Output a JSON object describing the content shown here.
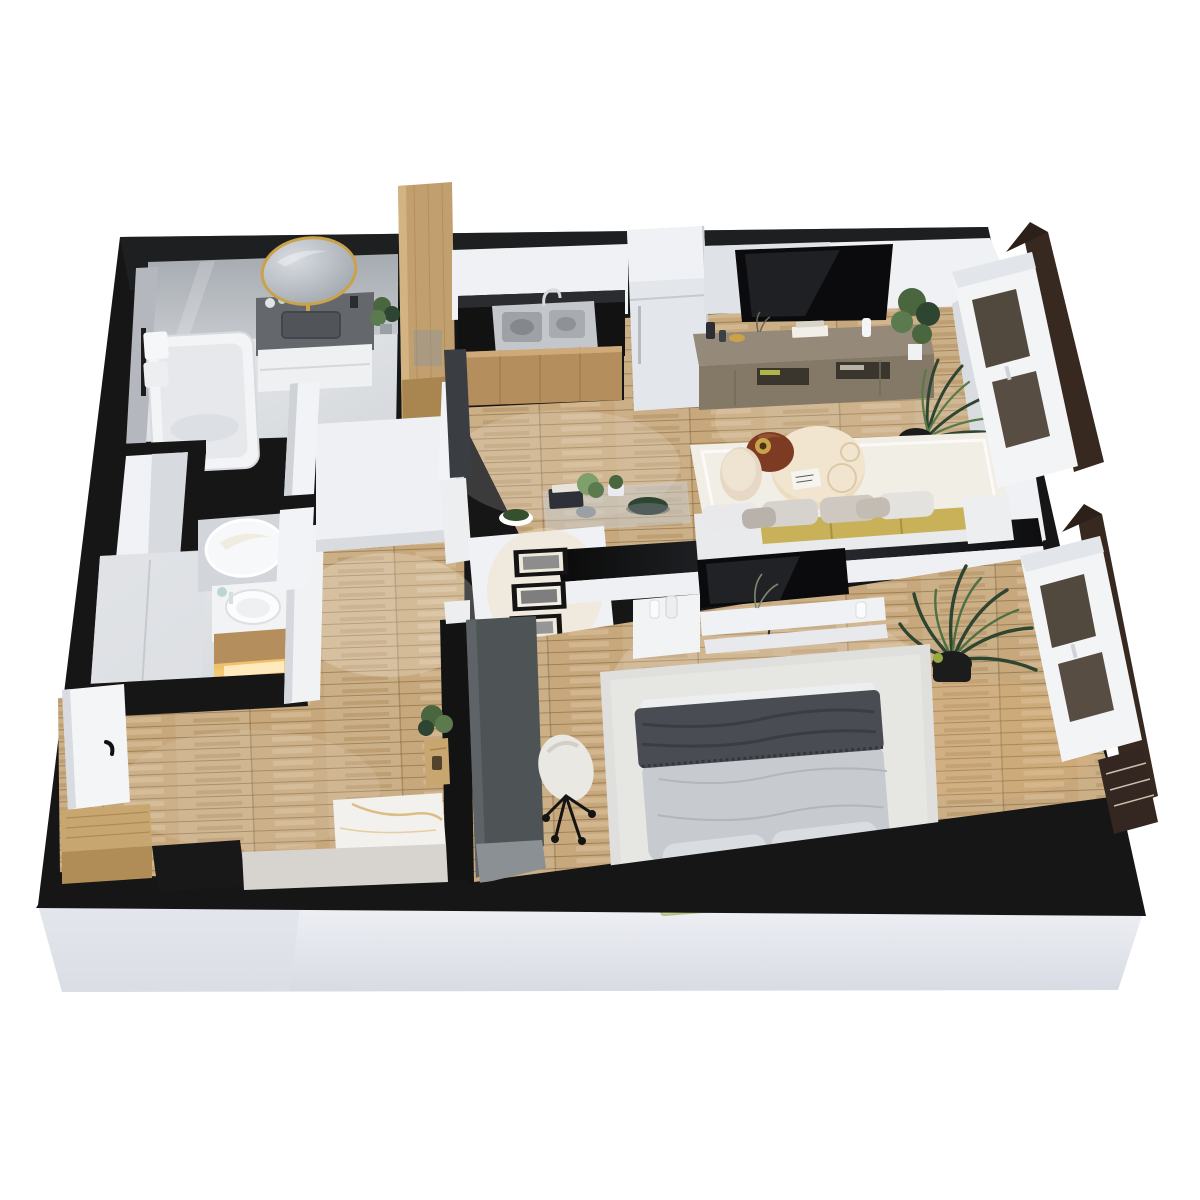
{
  "image": {
    "kind": "3d-floor-plan-render",
    "view": "isometric top-down",
    "apartment_type": "one-bedroom apartment",
    "visible_text": "none"
  },
  "palette": {
    "pageBg": "#ffffff",
    "wallBlack": "#161616",
    "wallBlackSheen": "#26282b",
    "fasciaLight": "#eef0f5",
    "fasciaDark": "#d8dbe3",
    "wallFaceWhite": "#eff1f4",
    "wallFaceGray": "#d9dbdf",
    "marbleLight": "#e9ebed",
    "marbleMid": "#d5d8db",
    "marbleDark": "#a6abb1",
    "wood": "#c7a87c",
    "woodDark": "#a9854f",
    "woodCabinet": "#b48e5c",
    "counterBlack": "#121212",
    "steel": "#c3c7cc",
    "fridge": "#e3e6ea",
    "tvBlack": "#0b0b0d",
    "consoleTaupe": "#95897a",
    "consoleTaupeDark": "#847866",
    "sofaWhite": "#e9eaec",
    "sofaGray": "#cdc6be",
    "seatMustard": "#c8b158",
    "tableCream": "#ecdcc2",
    "tableBrown": "#7e3b24",
    "rugLiving": "#f1eee6",
    "rugBedroom": "#dfdfdd",
    "bedDuvet": "#c7cacf",
    "bedThrow": "#494c53",
    "bedPillow": "#d9dce1",
    "headboardGreen": "#cdd5a0",
    "nightstandBrown": "#53351f",
    "deskGray": "#4e5456",
    "chairBoucle": "#eae8e2",
    "plantGreen": "#49663f",
    "plantDark": "#2e4531",
    "potBlack": "#1c1c1c",
    "windowBrown": "#372820",
    "gold": "#c9a24a",
    "glowWarm": "#f6c76d"
  },
  "scene": {
    "rooms": [
      {
        "id": "bathroom-main",
        "label": "bathroom",
        "contents": [
          "bathtub",
          "towel-rack with white towels",
          "gray vanity with sink and gold faucet",
          "round gold-framed mirror",
          "green plant",
          "gray marble walls"
        ]
      },
      {
        "id": "closet-niche",
        "label": "closet niche",
        "contents": [
          "open built-in niche"
        ]
      },
      {
        "id": "shower-room",
        "label": "shower room",
        "contents": [
          "walk-in marble shower",
          "round white mirror",
          "round vessel sink",
          "wood vanity with warm underlight"
        ]
      },
      {
        "id": "kitchen",
        "label": "kitchen",
        "contents": [
          "black countertop with backsplash",
          "stainless double sink",
          "wood base cabinets",
          "tall white fridge",
          "tall wood wardrobe column",
          "dark tall cabinet",
          "glass display table with books, plants and bowls"
        ]
      },
      {
        "id": "living-room",
        "label": "living room",
        "contents": [
          "wall-mounted TV",
          "taupe media console with decor",
          "white rug",
          "round cream coffee table",
          "brown side table with gold lamp",
          "cream pouf",
          "sofa with mustard seat and gray pillows",
          "two potted plants",
          "window with dark shutters"
        ]
      },
      {
        "id": "bedroom",
        "label": "bedroom",
        "contents": [
          "double bed with gray duvet and dark throw",
          "green headboard panels",
          "two dark nightstands",
          "light gray rug",
          "wall-mounted TV",
          "white floating shelves with vases",
          "tall palm in black pot",
          "dark gray desk",
          "white boucle desk chair",
          "three framed pictures",
          "window with dark shutters"
        ]
      },
      {
        "id": "entry-hall",
        "label": "entry hall",
        "contents": [
          "entry door with black handle",
          "wood bench",
          "black floor mat",
          "marble-top console",
          "plant stand"
        ]
      }
    ]
  }
}
